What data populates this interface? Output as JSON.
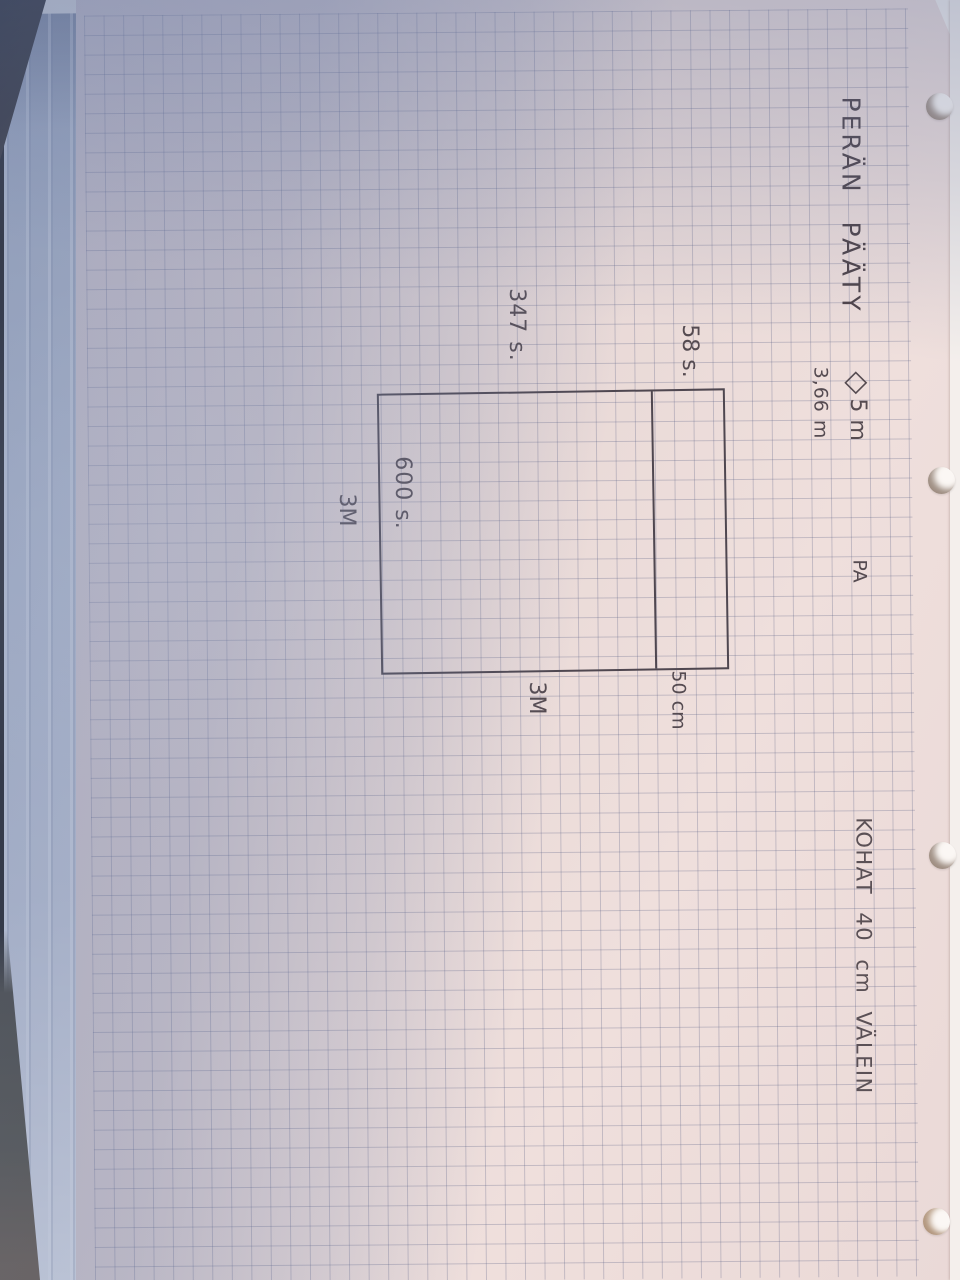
{
  "photo": {
    "paper_color": "#ead9d7",
    "shadow_color": "#b4bccd",
    "grid_line_color": "#8f94ae",
    "pencil_color": "#544a50"
  },
  "note": {
    "title": "PERÄN PÄÄTY",
    "materials": {
      "diamond_symbol": "◇",
      "diamond_value": "5 m",
      "length_note": "3,66 m",
      "label_pa": "PA"
    },
    "instruction": "KOHAT 40 cm VÄLEIN",
    "diagram": {
      "stitches_top": "347 s.",
      "stitches_top_right": "58 s.",
      "stitches_left": "600 s.",
      "meters_left": "3M",
      "meters_bottom": "3M",
      "strip_width": "50 cm"
    }
  }
}
